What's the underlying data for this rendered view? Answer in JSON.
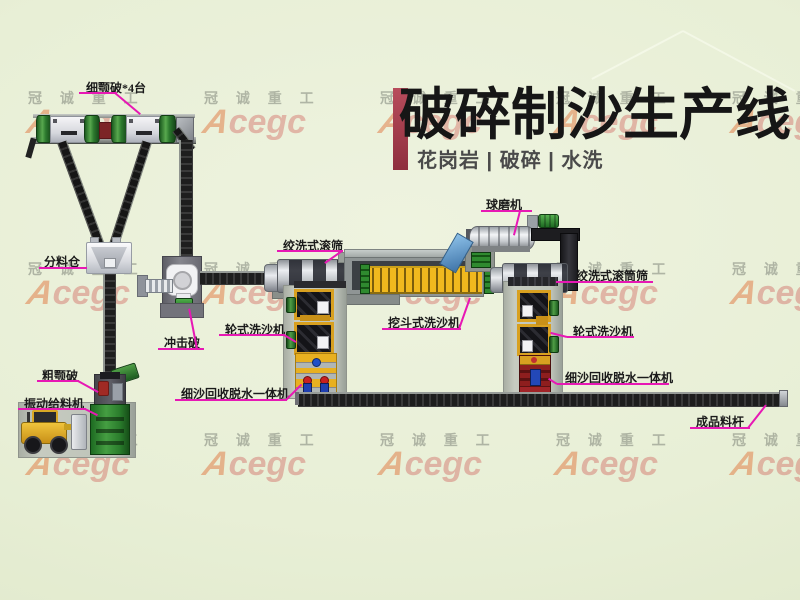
{
  "title": {
    "main": "破碎制沙生产线",
    "subtitle": "花岗岩 | 破碎 | 水洗"
  },
  "watermark": {
    "company": "冠 诚 重 工",
    "logo_a": "A",
    "logo_rest": "cegc"
  },
  "labels": {
    "fine_jaw": "细颚破*4台",
    "silo": "分料仓",
    "impact": "冲击破",
    "coarse_jaw": "粗颚破",
    "feeder": "振动给料机",
    "drum_screen_left": "绞洗式滚筛",
    "bucket_washer": "挖斗式洗沙机",
    "wheel_washer_left": "轮式洗沙机",
    "fine_sand_left": "细沙回收脱水一体机",
    "ball_mill": "球磨机",
    "drum_screen_right": "绞洗式滚筒筛",
    "wheel_washer_right": "轮式洗沙机",
    "fine_sand_right": "细沙回收脱水一体机",
    "product_bar": "成品料杆"
  },
  "colors": {
    "accent_bar": "#a8394b",
    "pointer_line": "#e718b4",
    "logo_red": "#c62828"
  }
}
